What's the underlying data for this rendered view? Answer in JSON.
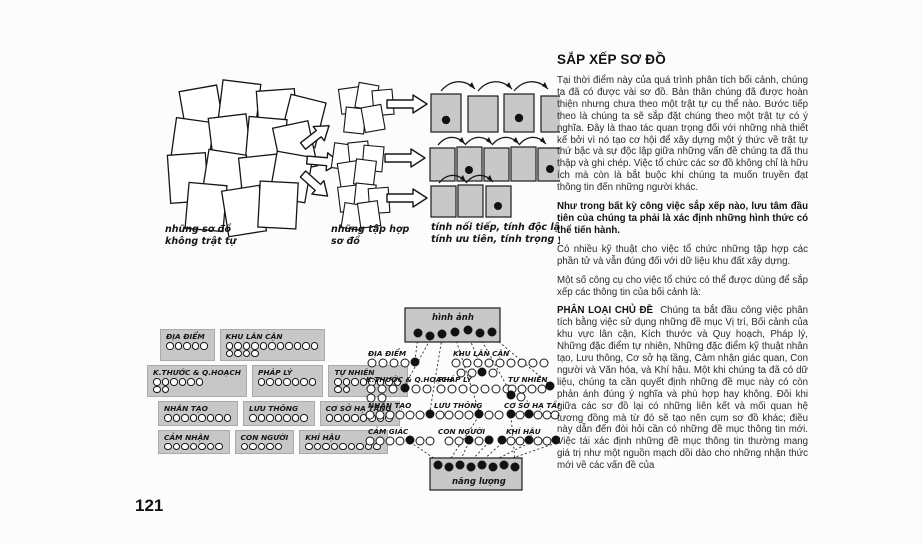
{
  "page_number": "121",
  "article": {
    "title": "SẮP XẾP SƠ ĐỒ",
    "para1": "Tại thời điểm này của quá trình phân tích bối cảnh, chúng ta đã có được vài sơ đồ. Bản thân chúng đã được hoàn thiện nhưng chưa theo một trật tự cụ thể nào. Bước tiếp theo là chúng ta sẽ sắp đặt chúng theo một trật tự có ý nghĩa. Đây là thao tác quan trọng đối với những nhà thiết kế bởi vì nó tạo cơ hội để xây dựng một ý thức về trật tự thứ bậc và sự độc lập giữa những vấn đề chúng ta đã thu thập và ghi chép. Việc tổ chức các sơ đồ không chỉ là hữu ích mà còn là bắt buộc khi chúng ta muốn truyền đạt thông tin đến những người khác.",
    "para2_bold": "Như trong bất kỳ công việc sắp xếp nào, lưu tâm đầu tiên của chúng ta phải là xác định những hình thức có thể tiến hành.",
    "para3": "Có nhiều kỹ thuật cho việc tổ chức những tập hợp các phần tử và vẫn đúng đối với dữ liệu khu đất xây dựng.",
    "para4": "Một số công cụ cho việc tổ chức có thể được dùng để sắp xếp các thông tin của bối cảnh là:",
    "section_heading": "PHÂN LOẠI CHỦ ĐỀ",
    "section_body": "Chúng ta bắt đầu công việc phân tích bằng việc sử dụng những đề mục Vị trí, Bối cảnh của khu vực lân cận, Kích thước và Quy hoạch, Pháp lý, Những đặc điểm tự nhiên, Những đặc điểm kỹ thuật nhân tạo, Lưu thông, Cơ sở hạ tầng, Cảm nhận giác quan, Con người và Văn hóa, và Khí hậu. Một khi chúng ta đã có dữ liệu, chúng ta cần quyết định những đề mục này có còn phản ánh đúng ý nghĩa và phù hợp hay không. Đôi khi giữa các sơ đồ lại có những liên kết và mối quan hệ tương đồng mà từ đó sẽ tạo nên cụm sơ đồ khác; điều này dẫn đến đòi hỏi cần có những đề mục thông tin mới. Việc tái xác định những đề mục thông tin thường mang giá trị như một nguồn mạch dồi dào cho những nhận thức mới về các vấn đề của"
  },
  "diagram_sort": {
    "label_pile_1": "những sơ đồ",
    "label_pile_2": "không trật tự",
    "label_groups_1": "những tập hợp",
    "label_groups_2": "sơ đồ",
    "label_ordered_1": "tính nối tiếp, tính độc lập",
    "label_ordered_2": "tính ưu tiên, tính trọng yếu"
  },
  "diagram_categories": {
    "rows": [
      [
        {
          "label": "ĐỊA ĐIỂM",
          "dots": [
            5
          ]
        },
        {
          "label": "KHU LÂN CẬN",
          "dots": [
            11,
            4
          ]
        }
      ],
      [
        {
          "label": "K.THƯỚC & Q.HOẠCH",
          "dots": [
            6,
            2
          ]
        },
        {
          "label": "PHÁP LÝ",
          "dots": [
            7
          ]
        },
        {
          "label": "TỰ NHIÊN",
          "dots": [
            8,
            2
          ]
        }
      ],
      [
        {
          "label": "NHÂN TẠO",
          "dots": [
            8
          ]
        },
        {
          "label": "LƯU THÔNG",
          "dots": [
            7
          ]
        },
        {
          "label": "CƠ SỞ HẠ TẦNG",
          "dots": [
            8
          ]
        }
      ],
      [
        {
          "label": "CẢM NHẬN",
          "dots": [
            7
          ]
        },
        {
          "label": "CON NGƯỜI",
          "dots": [
            5
          ]
        },
        {
          "label": "KHÍ HẬU",
          "dots": [
            9
          ]
        }
      ]
    ]
  },
  "diagram_network": {
    "top_box": "hình ảnh",
    "bottom_box": "năng lượng",
    "groups": [
      "ĐỊA ĐIỂM",
      "KHU LÂN CẬN",
      "K.THƯỚC & Q.HOẠCH",
      "PHÁP LÝ",
      "TỰ NHIÊN",
      "NHÂN TẠO",
      "LƯU THÔNG",
      "CƠ SỞ HẠ TẦNG",
      "CẢM GIÁC",
      "CON NGƯỜI",
      "KHÍ HẬU"
    ]
  },
  "colors": {
    "shaded_box": "#c8c8c8",
    "ink": "#161616"
  }
}
